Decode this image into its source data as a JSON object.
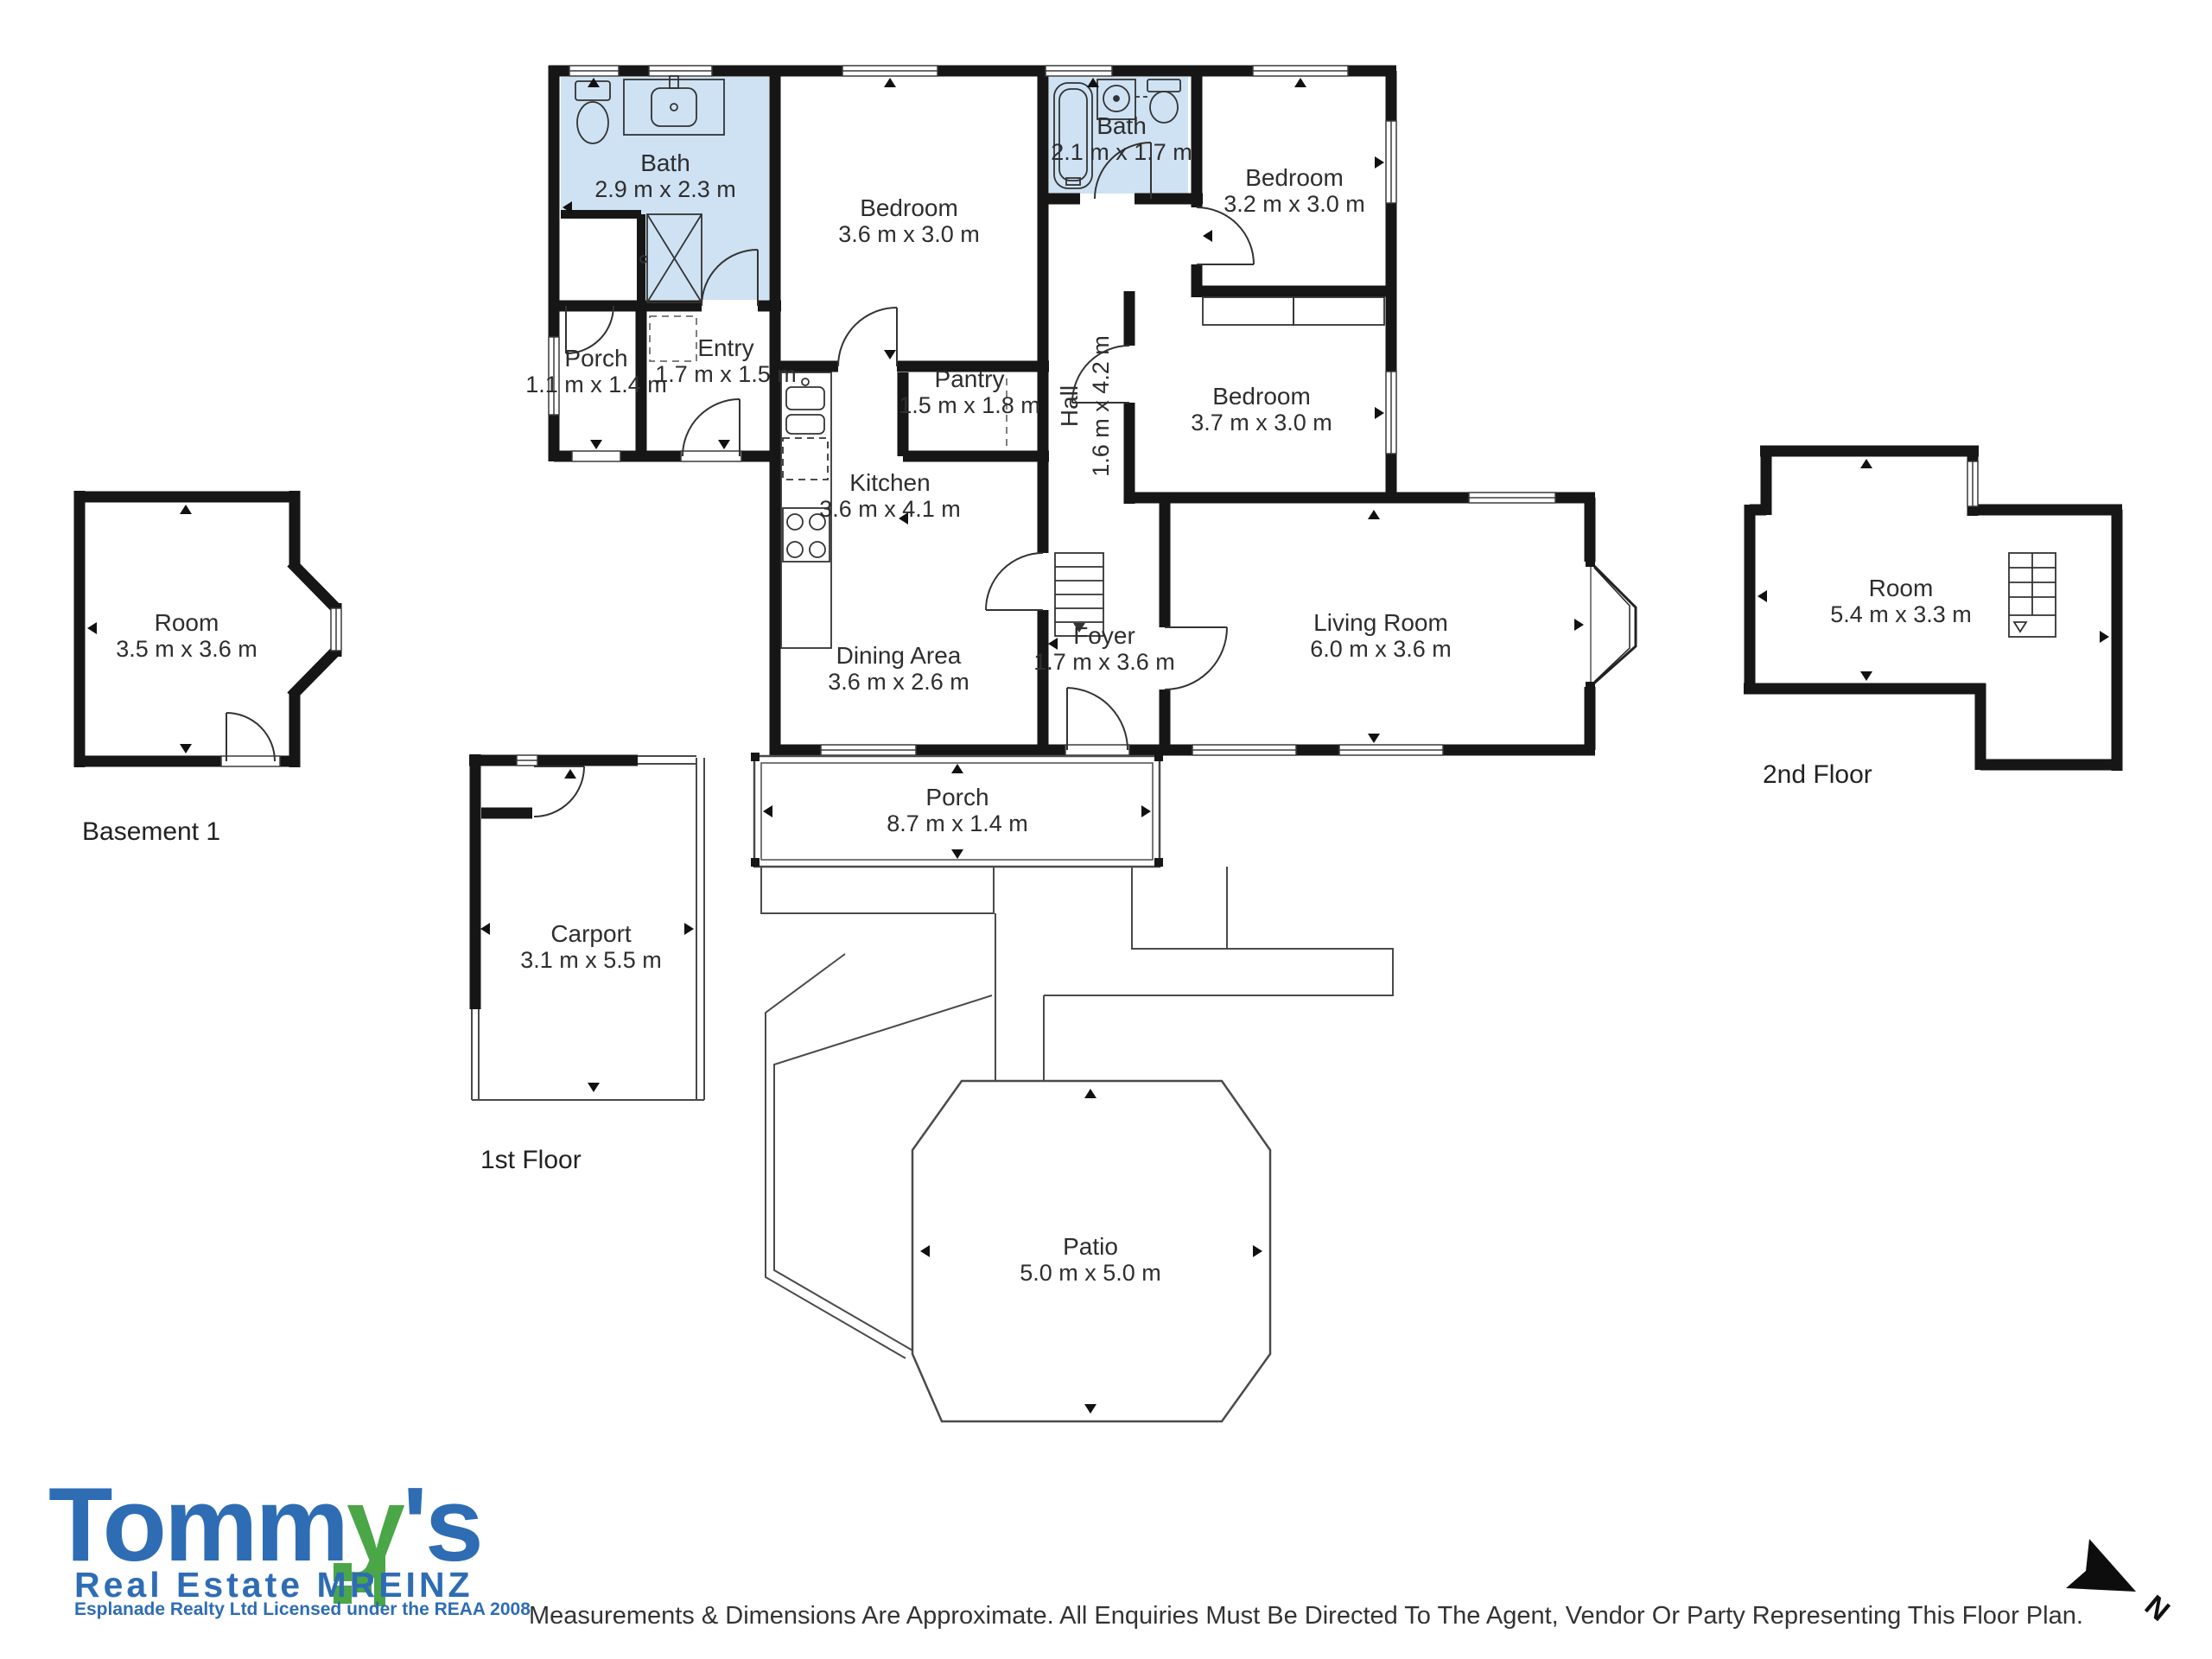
{
  "rooms": {
    "bath1": {
      "name": "Bath",
      "dims": "2.9 m x 2.3 m"
    },
    "porch1": {
      "name": "Porch",
      "dims": "1.1 m x 1.4 m"
    },
    "entry": {
      "name": "Entry",
      "dims": "1.7 m x 1.5 m"
    },
    "bedroom1": {
      "name": "Bedroom",
      "dims": "3.6 m x 3.0 m"
    },
    "bath2": {
      "name": "Bath",
      "dims": "2.1 m x 1.7 m"
    },
    "bedroom2": {
      "name": "Bedroom",
      "dims": "3.2 m x 3.0 m"
    },
    "hall": {
      "name": "Hall",
      "dims": "1.6 m x 4.2 m"
    },
    "pantry": {
      "name": "Pantry",
      "dims": "1.5 m x 1.8 m"
    },
    "bedroom3": {
      "name": "Bedroom",
      "dims": "3.7 m x 3.0 m"
    },
    "kitchen": {
      "name": "Kitchen",
      "dims": "3.6 m x 4.1 m"
    },
    "dining": {
      "name": "Dining Area",
      "dims": "3.6 m x 2.6 m"
    },
    "foyer": {
      "name": "Foyer",
      "dims": "1.7 m x 3.6 m"
    },
    "living": {
      "name": "Living Room",
      "dims": "6.0 m x 3.6 m"
    },
    "porch2": {
      "name": "Porch",
      "dims": "8.7 m x 1.4 m"
    },
    "carport": {
      "name": "Carport",
      "dims": "3.1 m x 5.5 m"
    },
    "patio": {
      "name": "Patio",
      "dims": "5.0 m x 5.0 m"
    },
    "basement_room": {
      "name": "Room",
      "dims": "3.5 m x 3.6 m"
    },
    "second_room": {
      "name": "Room",
      "dims": "5.4 m x 3.3 m"
    }
  },
  "floor_labels": {
    "basement": "Basement 1",
    "first": "1st Floor",
    "second": "2nd Floor"
  },
  "compass": {
    "label": "N"
  },
  "logo": {
    "brand_prefix": "Tomm",
    "brand_green": "y",
    "brand_suffix": "'s",
    "subtitle": "Real Estate MREINZ",
    "tagline": "Esplanade Realty Ltd Licensed under the REAA 2008",
    "blue": "#2e6db4",
    "green": "#4aa647"
  },
  "disclaimer": "Measurements & Dimensions Are Approximate. All Enquiries Must Be Directed To The Agent, Vendor Or Party Representing This Floor Plan.",
  "colors": {
    "wall": "#161616",
    "bath_fill": "#cfe2f3",
    "thin_line": "#4a4a4a",
    "text": "#2e2e2e"
  }
}
